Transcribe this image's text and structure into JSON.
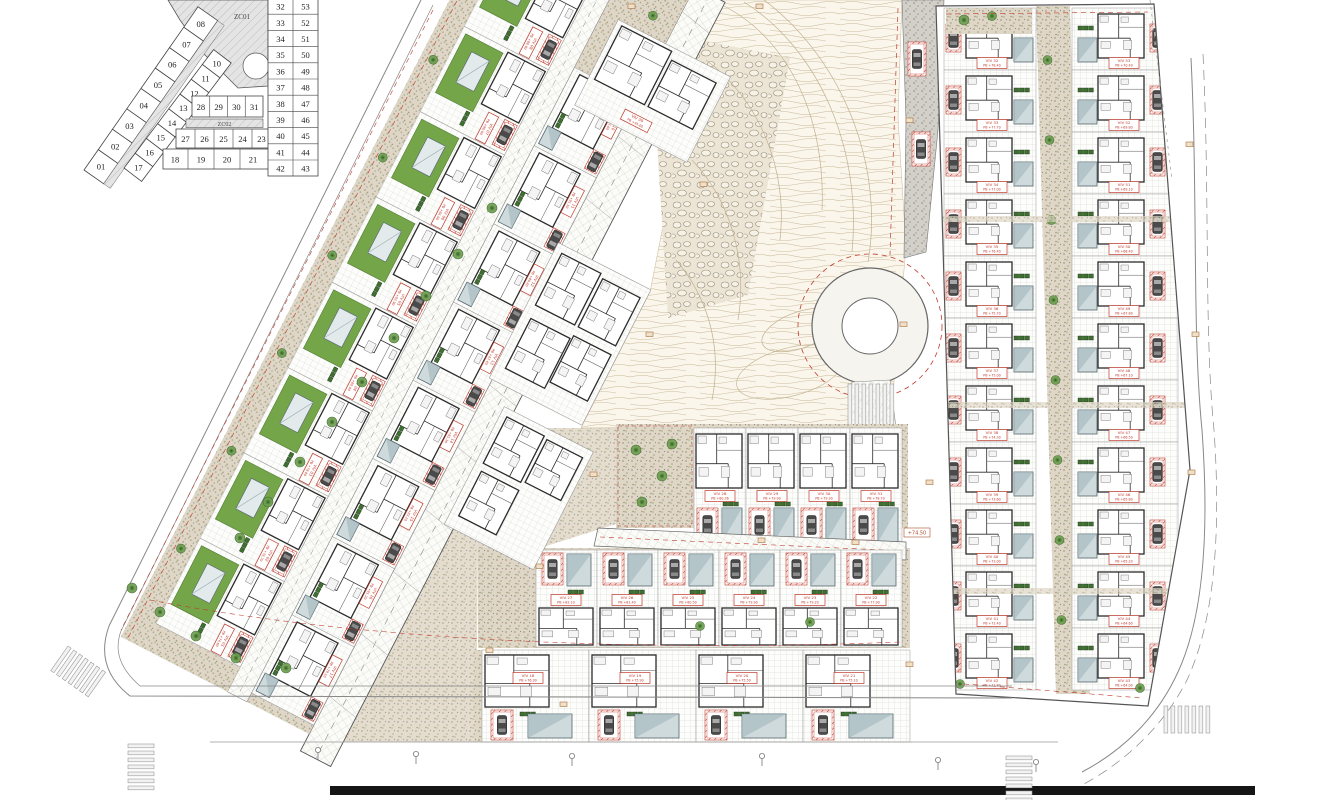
{
  "key_plan": {
    "zone_labels": {
      "zc01": "ZC01",
      "zc02": "ZC02"
    },
    "outer_row": [
      "01",
      "02",
      "03",
      "04",
      "05",
      "06",
      "07",
      "08"
    ],
    "inner_row": [
      "17",
      "16",
      "15",
      "14",
      "13",
      "12",
      "11",
      "10"
    ],
    "row_28_31": [
      "28",
      "29",
      "30",
      "31"
    ],
    "row_22_27": [
      "27",
      "26",
      "25",
      "24",
      "23",
      "22"
    ],
    "row_18_21": [
      "18",
      "19",
      "20",
      "21"
    ],
    "right_col_west": [
      "32",
      "33",
      "34",
      "35",
      "36",
      "37",
      "38",
      "39",
      "40",
      "41",
      "42"
    ],
    "right_col_east": [
      "53",
      "52",
      "51",
      "50",
      "49",
      "48",
      "47",
      "46",
      "45",
      "44",
      "43"
    ]
  },
  "site": {
    "road_level_tag": "+74.50",
    "villa_09": {
      "id": "VIV 09",
      "level": "PB +95.60"
    },
    "villas_left_outer": [
      {
        "id": "VIV 08",
        "level": "PB +88.90"
      },
      {
        "id": "VIV 07",
        "level": "PB +86.90"
      },
      {
        "id": "VIV 06",
        "level": "PB +84.90"
      },
      {
        "id": "VIV 05",
        "level": "PB +82.90"
      },
      {
        "id": "VIV 04",
        "level": "PB +80.90"
      },
      {
        "id": "VIV 03",
        "level": "PB +78.80"
      },
      {
        "id": "VIV 02",
        "level": "PB +76.70"
      },
      {
        "id": "VIV 01",
        "level": "PB +74.60"
      }
    ],
    "villas_left_inner": [
      {
        "id": "VIV 10",
        "level": "PB +93.60"
      },
      {
        "id": "VIV 11",
        "level": "PB +91.50"
      },
      {
        "id": "VIV 12",
        "level": "PB +89.40"
      },
      {
        "id": "VIV 13",
        "level": "PB +87.40"
      },
      {
        "id": "VIV 14",
        "level": "PB +85.30"
      },
      {
        "id": "VIV 15",
        "level": "PB +83.20"
      },
      {
        "id": "VIV 16",
        "level": "PB +81.20"
      },
      {
        "id": "VIV 17",
        "level": "PB +79.10"
      }
    ],
    "villas_row_upper": [
      {
        "id": "VIV 28",
        "level": "PB +80.36"
      },
      {
        "id": "VIV 29",
        "level": "PB +79.90"
      },
      {
        "id": "VIV 30",
        "level": "PB +79.30"
      },
      {
        "id": "VIV 31",
        "level": "PB +78.70"
      }
    ],
    "villas_row_mid": [
      {
        "id": "VIV 27",
        "level": "PB +82.10"
      },
      {
        "id": "VIV 26",
        "level": "PB +81.40"
      },
      {
        "id": "VIV 25",
        "level": "PB +80.50"
      },
      {
        "id": "VIV 24",
        "level": "PB +79.90"
      },
      {
        "id": "VIV 23",
        "level": "PB +79.20"
      },
      {
        "id": "VIV 22",
        "level": "PB +77.90"
      }
    ],
    "villas_row_lower": [
      {
        "id": "VIV 18",
        "level": "PB +76.30"
      },
      {
        "id": "VIV 19",
        "level": "PB +75.90"
      },
      {
        "id": "VIV 20",
        "level": "PB +75.50"
      },
      {
        "id": "VIV 21",
        "level": "PB +75.10"
      }
    ],
    "villas_right_west": [
      {
        "id": "VIV 32",
        "level": "PB +78.40"
      },
      {
        "id": "VIV 33",
        "level": "PB +77.70"
      },
      {
        "id": "VIV 34",
        "level": "PB +77.00"
      },
      {
        "id": "VIV 35",
        "level": "PB +76.40"
      },
      {
        "id": "VIV 36",
        "level": "PB +75.70"
      },
      {
        "id": "VIV 37",
        "level": "PB +75.00"
      },
      {
        "id": "VIV 38",
        "level": "PB +74.30"
      },
      {
        "id": "VIV 39",
        "level": "PB +73.60"
      },
      {
        "id": "VIV 40",
        "level": "PB +73.00"
      },
      {
        "id": "VIV 41",
        "level": "PB +72.40"
      },
      {
        "id": "VIV 42",
        "level": "PB +71.80"
      }
    ],
    "villas_right_east": [
      {
        "id": "VIV 53",
        "level": "PB +70.40"
      },
      {
        "id": "VIV 52",
        "level": "PB +69.80"
      },
      {
        "id": "VIV 51",
        "level": "PB +69.10"
      },
      {
        "id": "VIV 50",
        "level": "PB +68.40"
      },
      {
        "id": "VIV 49",
        "level": "PB +67.80"
      },
      {
        "id": "VIV 48",
        "level": "PB +67.10"
      },
      {
        "id": "VIV 47",
        "level": "PB +66.50"
      },
      {
        "id": "VIV 46",
        "level": "PB +65.80"
      },
      {
        "id": "VIV 45",
        "level": "PB +65.20"
      },
      {
        "id": "VIV 44",
        "level": "PB +64.60"
      },
      {
        "id": "VIV 43",
        "level": "PB +64.00"
      }
    ]
  },
  "colors": {
    "lawn": "#74a548",
    "pool": "#cfdadd",
    "red": "#c0392b",
    "sand": "#ded6c6",
    "contour": "#c9b794",
    "road_gray": "#d3d0ca",
    "wall": "#2b2b2b",
    "tree": "#6d9e50"
  }
}
